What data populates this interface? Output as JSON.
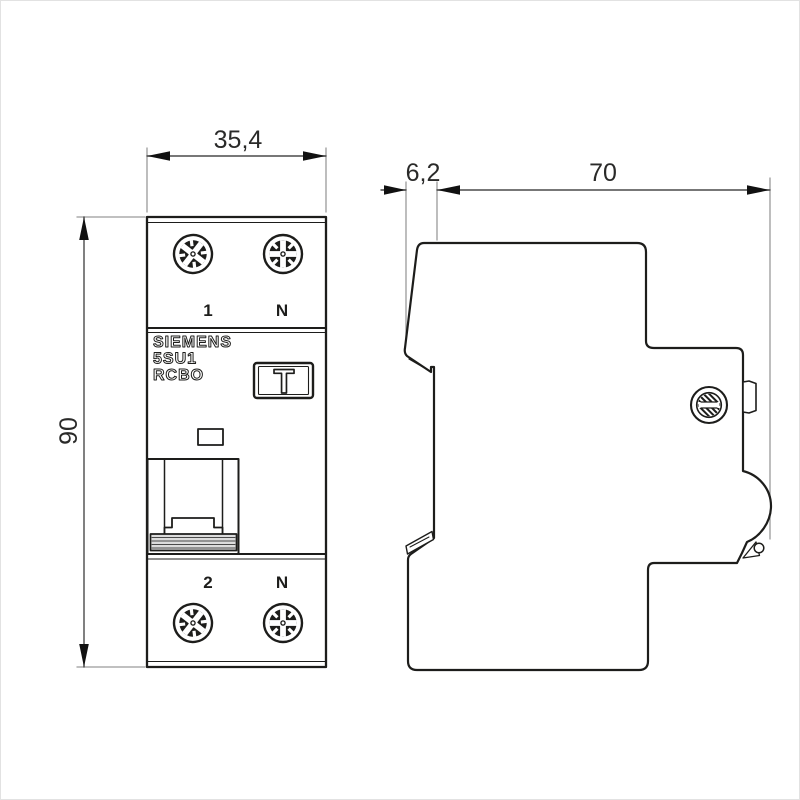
{
  "drawing": {
    "title": "Siemens 5SU1 RCBO dimensional drawing",
    "colors": {
      "line": "#1d1d1b",
      "dim_line": "#4a4a4a",
      "ext_line": "#9a9a9a",
      "grip_fill": "#dcdcdc",
      "background": "#ffffff"
    },
    "dimensions": {
      "front_width": "35,4",
      "front_height": "90",
      "side_front_depth": "6,2",
      "side_depth": "70"
    },
    "front_view": {
      "terminal_top_left": "1",
      "terminal_top_right": "N",
      "terminal_bottom_left": "2",
      "terminal_bottom_right": "N",
      "brand": "SIEMENS",
      "model": "5SU1",
      "type": "RCBO",
      "test_button": "T"
    }
  }
}
